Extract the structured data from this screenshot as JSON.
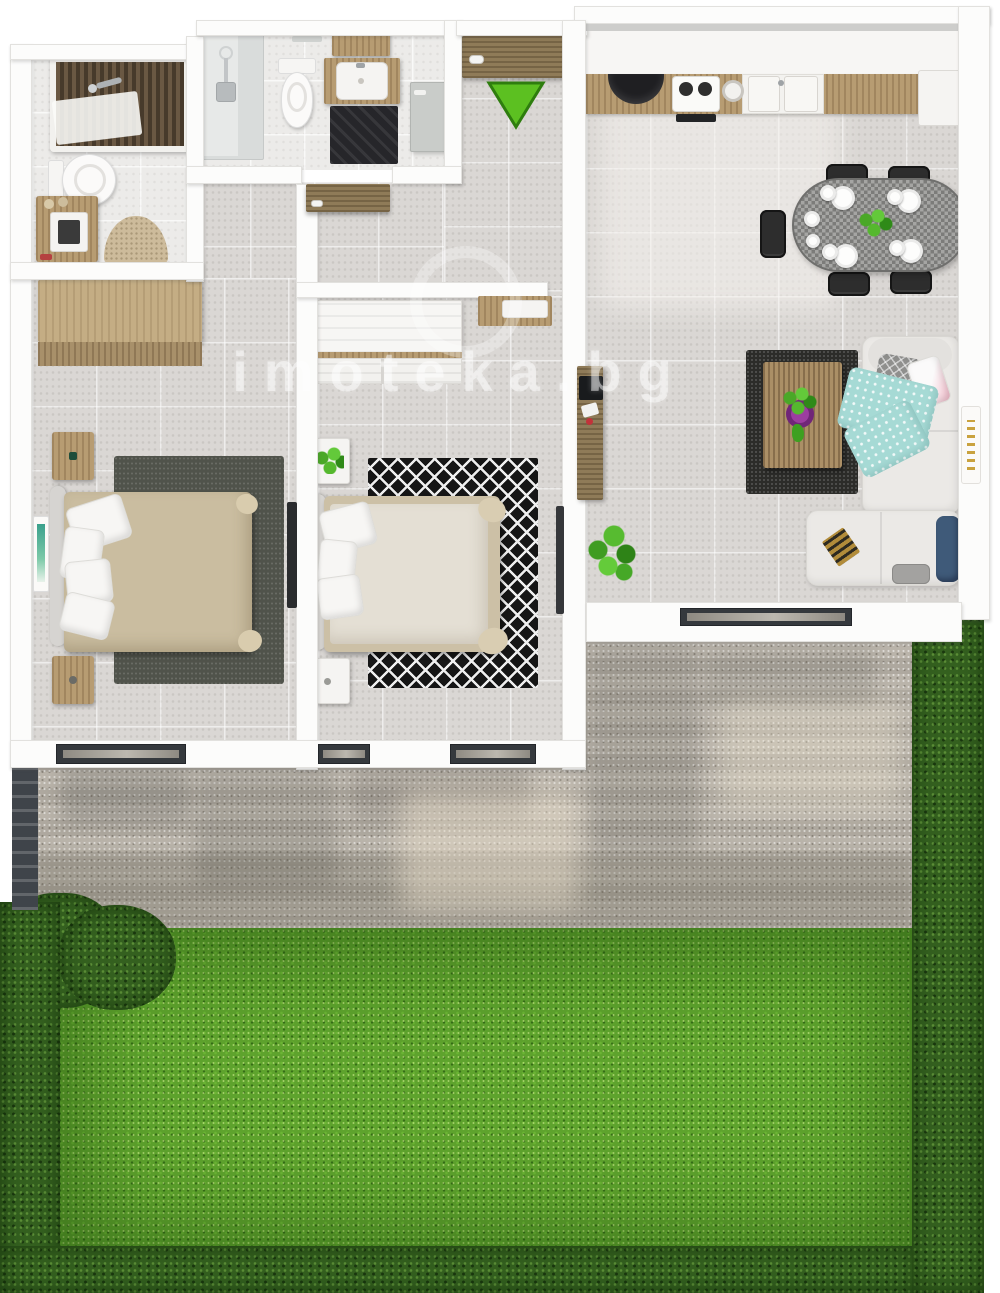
{
  "image": {
    "kind": "3d-floor-plan-top-down-render",
    "subject": "two-bedroom apartment with terrace and garden"
  },
  "watermark": {
    "text": "imoteka.bg",
    "logo": "house-in-ring"
  },
  "entrance": {
    "marker": "green-arrow-down",
    "color": "#5cc021"
  },
  "palette": {
    "wall": "#fcfcfb",
    "floor_tile": "#dad7d4",
    "bath_floor": "#ecebe9",
    "wood_light": "#c4ad84",
    "wood": "#b79c72",
    "wood_dark": "#8f7b58",
    "rug_bedroom1": "#50534b",
    "rug_bedroom2": "#161616",
    "rug_living": "#2c2c29",
    "sofa": "#ebe9e6",
    "bed1_duvet": "#cabda0",
    "bed2_duvet": "#e4dfd4",
    "dining_chair": "#2d2d2d",
    "dining_table": "#90908e",
    "blanket_teal": "#a6dad5",
    "cushion_navy": "#3f5a79",
    "bowl_purple": "#9c3da0",
    "terrace_gravel": "#b6b0a6",
    "lawn": "#5ea32d",
    "hedge": "#34601f",
    "sliding_door_frame": "#35393d",
    "sink_black": "#1f1f22"
  },
  "rooms": [
    {
      "id": "bathroom-1",
      "label": "bathroom",
      "items": [
        "bathtub-with-wood-slats",
        "faucet",
        "toilet",
        "wood-vanity-with-sink",
        "half-round-bath-mat"
      ]
    },
    {
      "id": "bathroom-2",
      "label": "shower room",
      "items": [
        "shower-cabin",
        "toilet",
        "wood-vanity-with-sink",
        "upper-cabinet",
        "dark-rug",
        "door"
      ]
    },
    {
      "id": "entry",
      "label": "entry",
      "items": [
        "entrance-door",
        "entrance-arrow"
      ]
    },
    {
      "id": "hallway",
      "label": "hallway",
      "items": [
        "interior-door",
        "wood-niche-with-drawer"
      ]
    },
    {
      "id": "bedroom-1",
      "label": "bedroom",
      "items": [
        "wood-wardrobe",
        "double-bed",
        "pillows",
        "nightstand-left-top",
        "nightstand-left-bottom",
        "dark-rug",
        "wall-tv",
        "wall-art",
        "sliding-terrace-door"
      ]
    },
    {
      "id": "bedroom-2",
      "label": "bedroom",
      "items": [
        "white-wardrobe",
        "double-bed",
        "pillows",
        "nightstand-top-with-plant",
        "nightstand-bottom",
        "diamond-rug",
        "wall-tv",
        "sliding-terrace-doors"
      ]
    },
    {
      "id": "kitchen-living",
      "label": "kitchen / living room",
      "items": [
        "upper-cabinets",
        "wood-counter",
        "black-corner-sink",
        "cooktop",
        "round-sink",
        "double-basin",
        "kitchen-mat",
        "dining-table",
        "five-dining-chairs",
        "plates",
        "table-centerpiece-plant",
        "corner-sofa",
        "teal-blanket",
        "pillows",
        "navy-cushion",
        "magazine",
        "coffee-table",
        "purple-bowl",
        "dark-rug",
        "tv-console",
        "potted-plant",
        "wall-art",
        "sliding-terrace-door"
      ]
    },
    {
      "id": "terrace",
      "label": "terrace",
      "items": [
        "gravel-paving",
        "wall-shadows",
        "fence-posts"
      ]
    },
    {
      "id": "garden",
      "label": "garden",
      "items": [
        "lawn",
        "hedge-bush",
        "hedge-left",
        "hedge-bottom",
        "hedge-right"
      ]
    }
  ]
}
